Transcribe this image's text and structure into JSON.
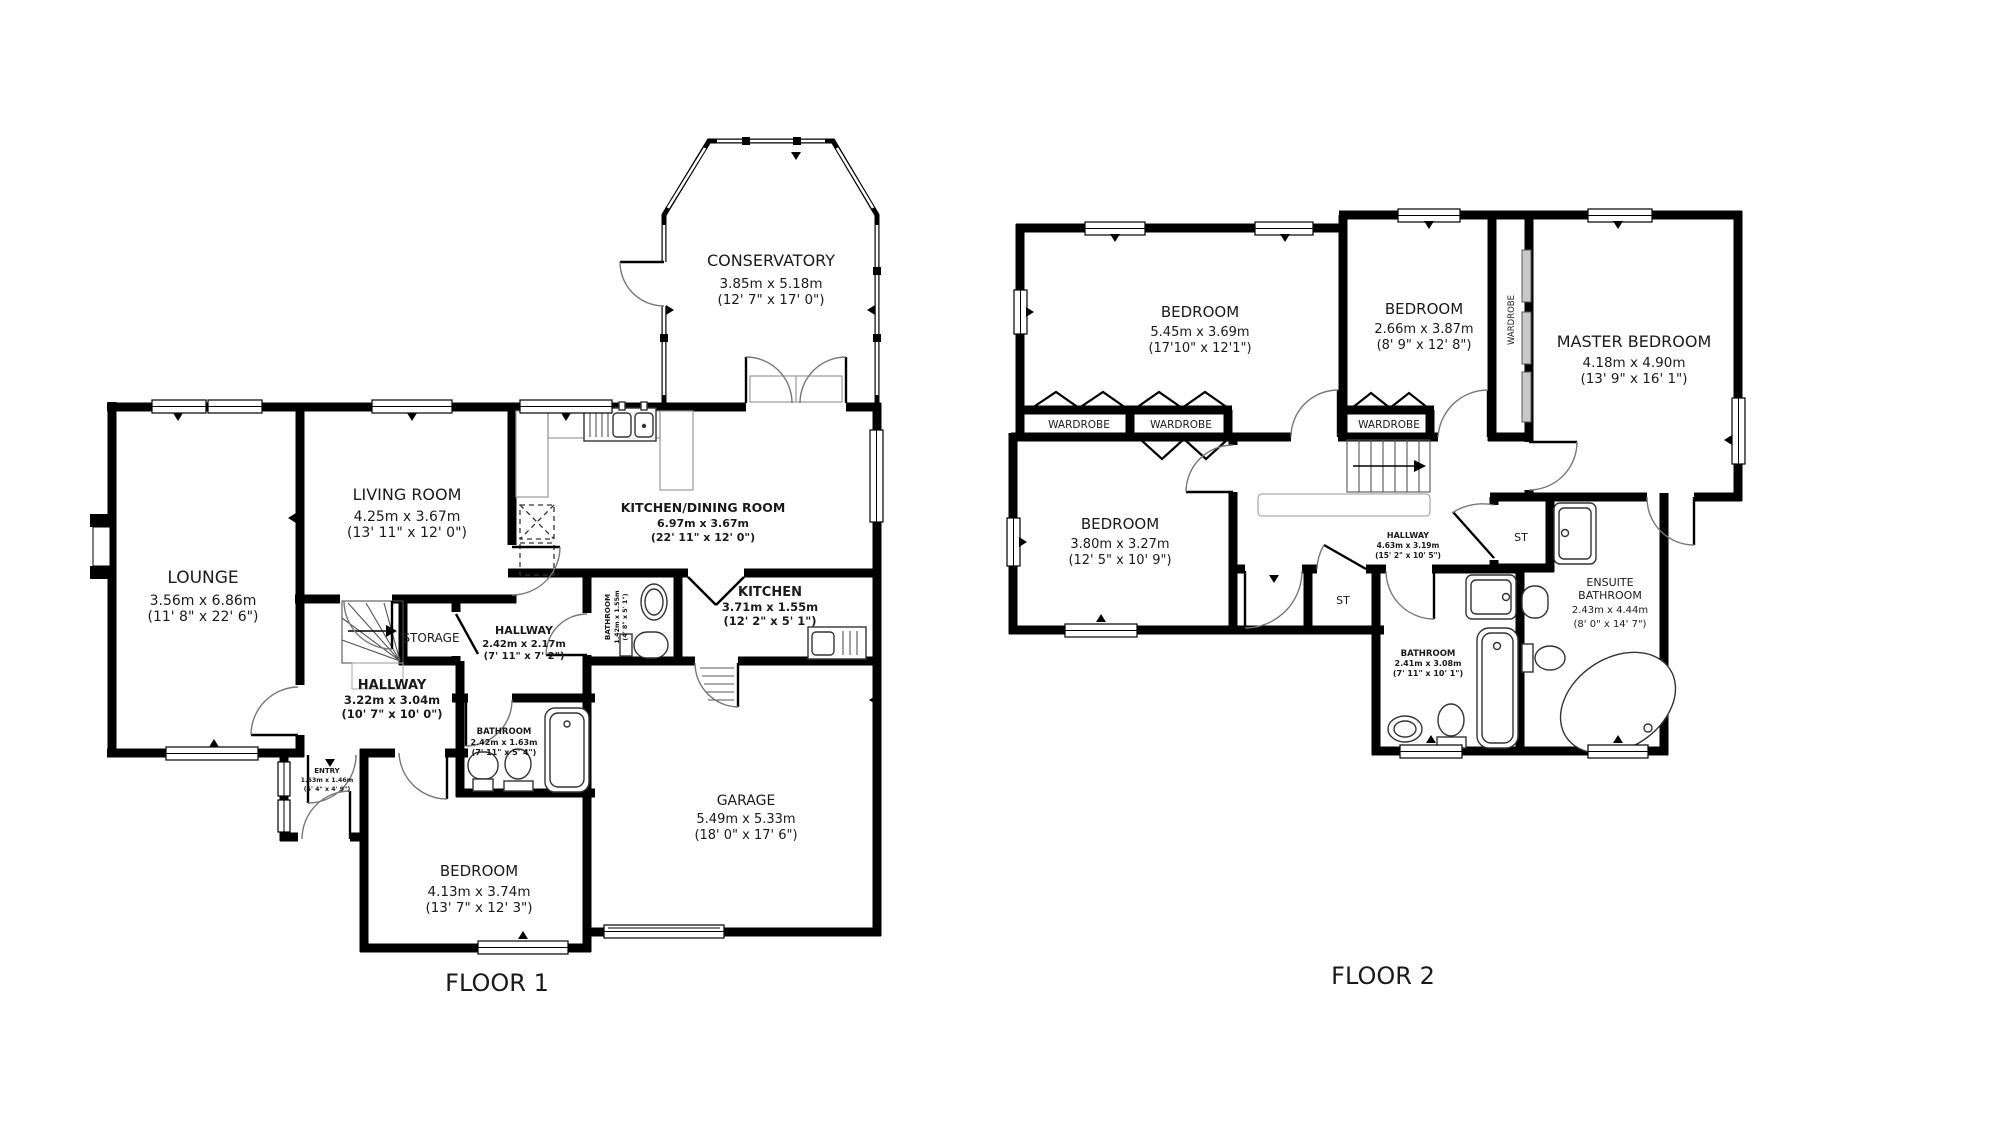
{
  "floor1": {
    "label": "FLOOR 1",
    "rooms": {
      "conservatory": {
        "name": "CONSERVATORY",
        "metric": "3.85m x 5.18m",
        "imperial": "(12' 7\" x 17' 0\")"
      },
      "lounge": {
        "name": "LOUNGE",
        "metric": "3.56m x 6.86m",
        "imperial": "(11' 8\" x 22' 6\")"
      },
      "living_room": {
        "name": "LIVING ROOM",
        "metric": "4.25m x 3.67m",
        "imperial": "(13' 11\" x 12' 0\")"
      },
      "kitchen_dining": {
        "name": "KITCHEN/DINING ROOM",
        "metric": "6.97m x 3.67m",
        "imperial": "(22' 11\" x 12' 0\")"
      },
      "kitchen": {
        "name": "KITCHEN",
        "metric": "3.71m x 1.55m",
        "imperial": "(12' 2\" x 5' 1\")"
      },
      "wc": {
        "name": "BATHROOM",
        "metric": "1.42m x 1.55m",
        "imperial": "(4' 8\" x 5' 1\")"
      },
      "storage": {
        "name": "STORAGE"
      },
      "hallway_upper": {
        "name": "HALLWAY",
        "metric": "2.42m x 2.17m",
        "imperial": "(7' 11\" x 7' 2\")"
      },
      "hallway_lower": {
        "name": "HALLWAY",
        "metric": "3.22m x 3.04m",
        "imperial": "(10' 7\" x 10' 0\")"
      },
      "bathroom": {
        "name": "BATHROOM",
        "metric": "2.42m x 1.63m",
        "imperial": "(7' 11\" x 5' 4\")"
      },
      "entry": {
        "name": "ENTRY",
        "metric": "1.63m x 1.46m",
        "imperial": "(5' 4\" x 4' 9\")"
      },
      "bedroom": {
        "name": "BEDROOM",
        "metric": "4.13m x 3.74m",
        "imperial": "(13' 7\" x 12' 3\")"
      },
      "garage": {
        "name": "GARAGE",
        "metric": "5.49m x 5.33m",
        "imperial": "(18' 0\" x 17' 6\")"
      }
    }
  },
  "floor2": {
    "label": "FLOOR 2",
    "rooms": {
      "bedroom_left": {
        "name": "BEDROOM",
        "metric": "5.45m x 3.69m",
        "imperial": "(17'10\" x 12'1\")"
      },
      "bedroom_middle": {
        "name": "BEDROOM",
        "metric": "2.66m x 3.87m",
        "imperial": "(8' 9\" x 12' 8\")"
      },
      "master_bedroom": {
        "name": "MASTER BEDROOM",
        "metric": "4.18m x 4.90m",
        "imperial": "(13' 9\" x 16' 1\")"
      },
      "bedroom_lower": {
        "name": "BEDROOM",
        "metric": "3.80m x 3.27m",
        "imperial": "(12' 5\" x 10' 9\")"
      },
      "hallway": {
        "name": "HALLWAY",
        "metric": "4.63m x 3.19m",
        "imperial": "(15' 2\" x 10' 5\")"
      },
      "bathroom": {
        "name": "BATHROOM",
        "metric": "2.41m x 3.08m",
        "imperial": "(7' 11\" x 10' 1\")"
      },
      "ensuite": {
        "name_line1": "ENSUITE",
        "name_line2": "BATHROOM",
        "metric": "2.43m x 4.44m",
        "imperial": "(8' 0\" x 14' 7\")"
      },
      "wardrobe_label": "WARDROBE",
      "storage_label": "ST"
    }
  },
  "colors": {
    "wall": "#000000",
    "text": "#1a1a1a",
    "fixture": "#333333",
    "arc": "#777777"
  }
}
